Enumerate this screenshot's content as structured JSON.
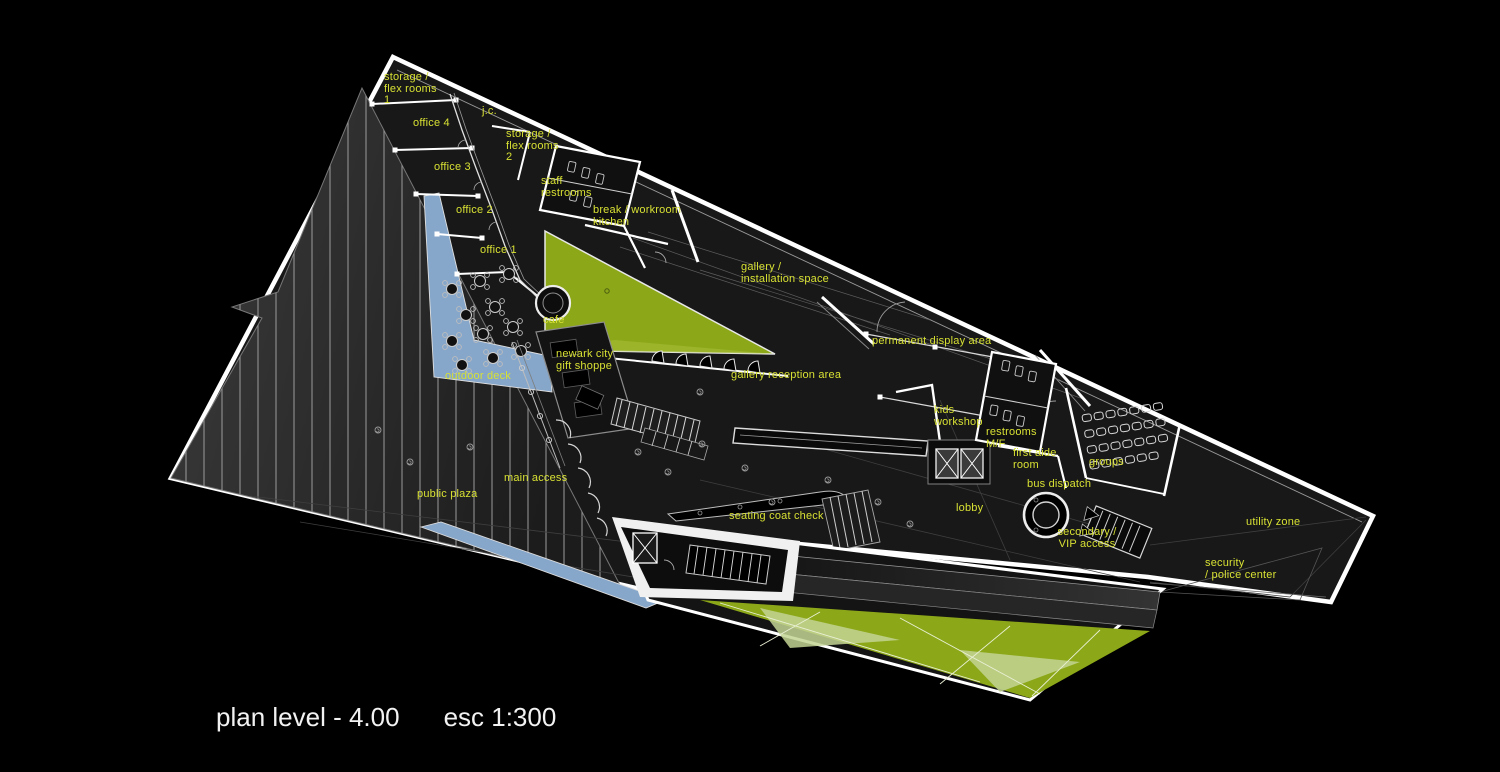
{
  "plan": {
    "caption": {
      "level": "plan level - 4.00",
      "scale": "esc 1:300"
    },
    "colors": {
      "background": "#000000",
      "building_fill": "#181818",
      "outline_white": "#ffffff",
      "label_yellow": "#d7e033",
      "caption_white": "#f2f2f2",
      "landscape_green": "#8ca818",
      "landscape_green_light": "#c3d394",
      "water_blue": "#87a7ca"
    },
    "labels": {
      "storage_flex_1": "storage /\nflex rooms\n1",
      "jc": "j.c.",
      "office_4": "office 4",
      "storage_flex_2": "storage /\nflex rooms\n2",
      "office_3": "office 3",
      "staff_restrooms": "staff\nrestrooms",
      "office_2": "office 2",
      "break_workroom": "break / workroom\nkitchen",
      "office_1": "office 1",
      "gallery_installation": "gallery /\ninstallation space",
      "cafe": "cafe",
      "permanent_display": "permanent display area",
      "newark_gift": "newark city\ngift shoppe",
      "outdoor_deck": "outdoor deck",
      "gallery_reception": "gallery reception area",
      "kids_workshop": "kids\nworkshop",
      "restrooms_mf": "restrooms\nM/F",
      "first_aide": "first aide\nroom",
      "groups": "groups",
      "main_access": "main access",
      "public_plaza": "public plaza",
      "bus_dispatch": "bus dispatch",
      "lobby": "lobby",
      "seating_coat_check": "seating coat check",
      "utility_zone": "utility zone",
      "secondary_vip": "secondary /\nVIP access",
      "security_police": "security\n/ police center"
    }
  }
}
